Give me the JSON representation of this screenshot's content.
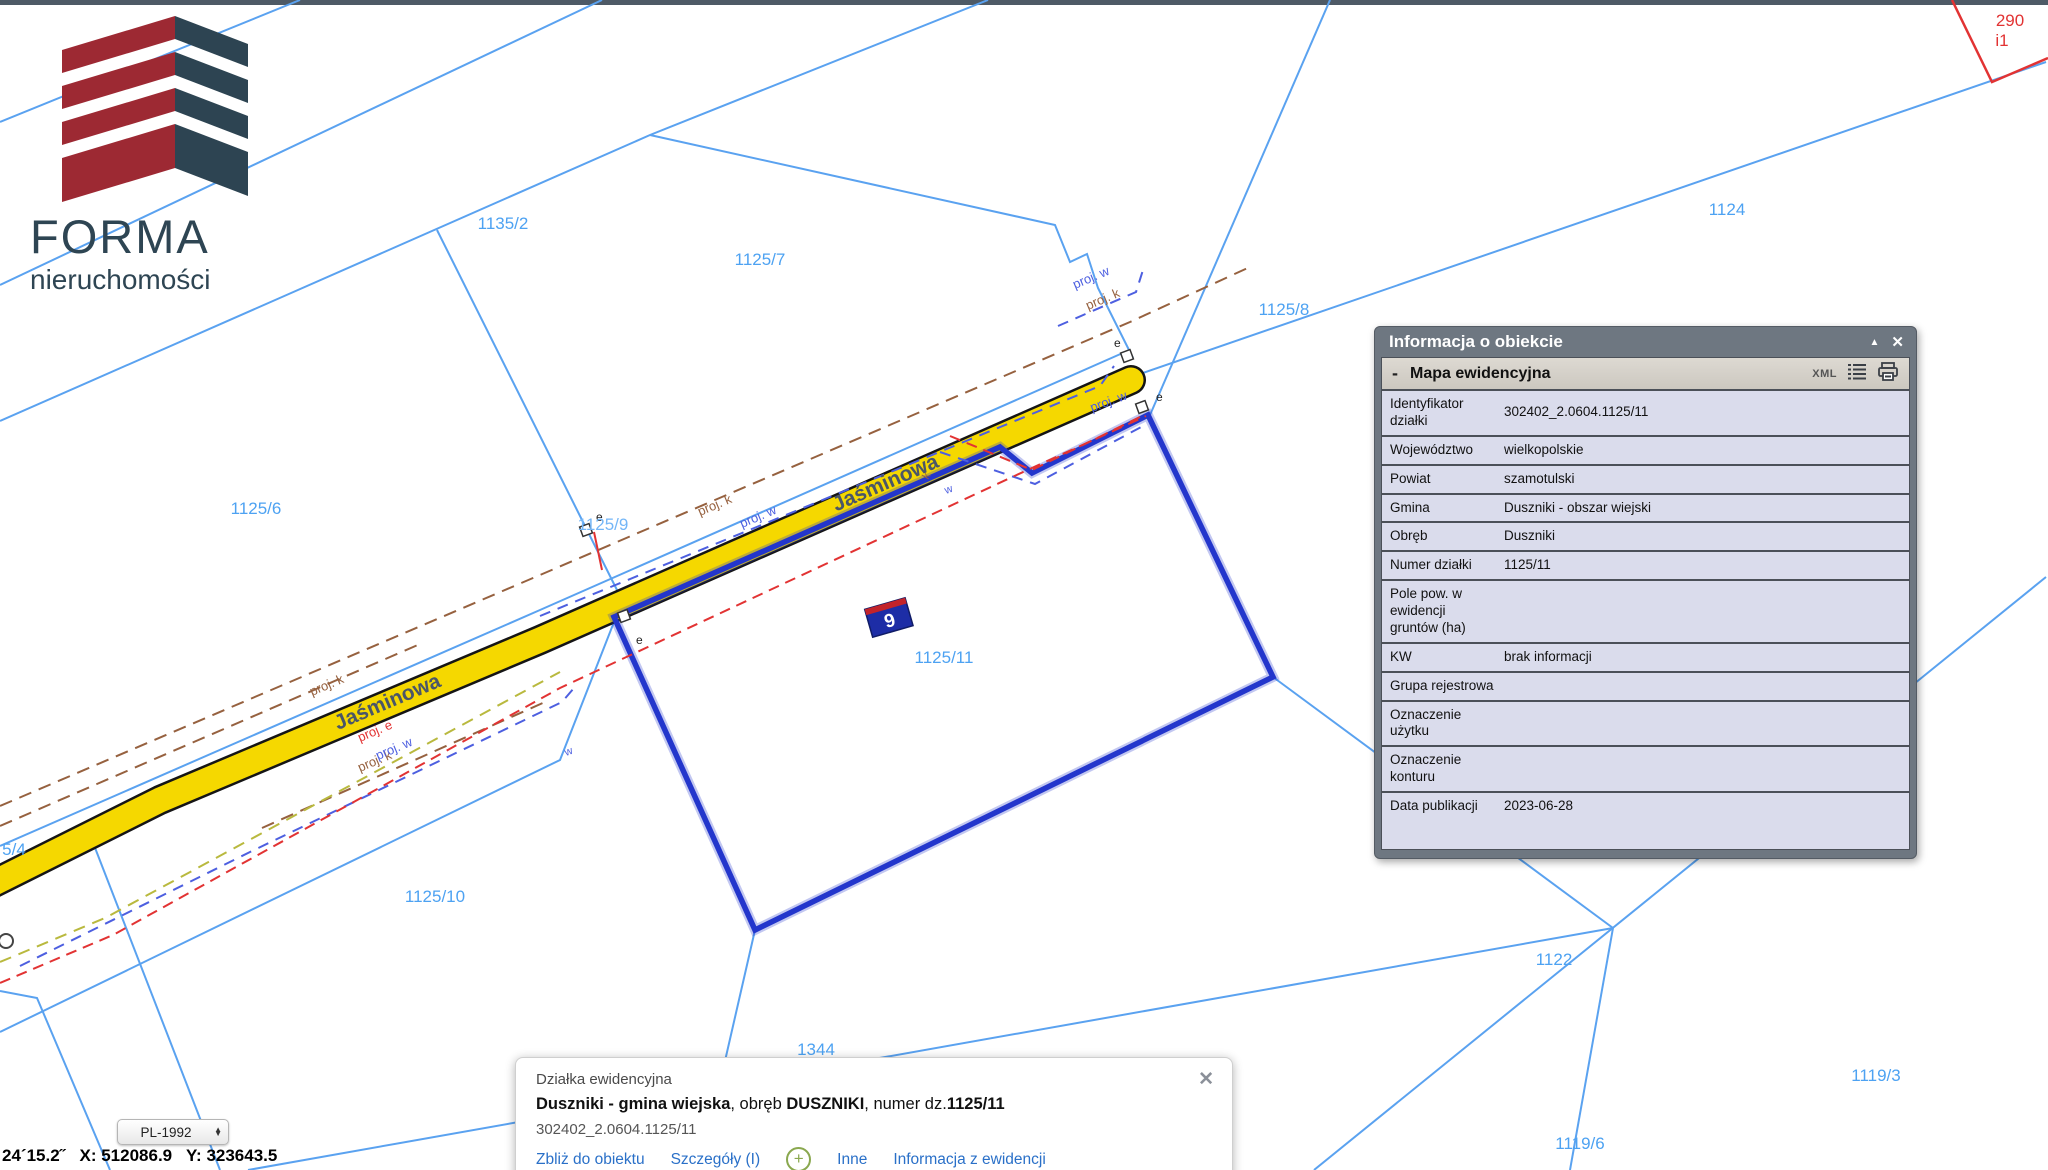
{
  "logo": {
    "name": "FORMA",
    "subtitle": "nieruchomości"
  },
  "map": {
    "street": "Jaśminowa",
    "parcels": [
      "1135",
      "1135/2",
      "1125/7",
      "1125/8",
      "1124",
      "1125/6",
      "1125/9",
      "1125/11",
      "1125/10",
      "1122",
      "1119/3",
      "1119/6",
      "1344",
      "5/4",
      "290",
      "i1"
    ],
    "proj": {
      "k": "proj. k",
      "w": "proj. w",
      "e": "proj. e"
    },
    "tiny": {
      "k": "k",
      "w": "w"
    },
    "house_number": "9",
    "e_symbol": "e",
    "colors": {
      "boundary": "#5aa2f0",
      "selection": "#2336cc",
      "road_fill": "#f5d800",
      "road_casing": "#151515",
      "parcel_label": "#4da2f2",
      "red": "#e23333",
      "brown": "#96613f",
      "proj_blue": "#4d5fe0",
      "olive": "#b9b93e"
    }
  },
  "info_panel": {
    "title": "Informacja o obiekcie",
    "collapse_icon": "▲",
    "close_icon": "✕",
    "section": {
      "minus": "-",
      "title": "Mapa ewidencyjna",
      "xml": "XML"
    },
    "rows": [
      {
        "label": "Identyfikator działki",
        "value": "302402_2.0604.1125/11"
      },
      {
        "label": "Województwo",
        "value": "wielkopolskie"
      },
      {
        "label": "Powiat",
        "value": "szamotulski"
      },
      {
        "label": "Gmina",
        "value": "Duszniki - obszar wiejski"
      },
      {
        "label": "Obręb",
        "value": "Duszniki"
      },
      {
        "label": "Numer działki",
        "value": "1125/11"
      },
      {
        "label": "Pole pow. w ewidencji gruntów (ha)",
        "value": ""
      },
      {
        "label": "KW",
        "value": "brak informacji"
      },
      {
        "label": "Grupa rejestrowa",
        "value": ""
      },
      {
        "label": "Oznaczenie użytku",
        "value": ""
      },
      {
        "label": "Oznaczenie konturu",
        "value": ""
      },
      {
        "label": "Data publikacji",
        "value": "2023-06-28"
      }
    ]
  },
  "popup": {
    "title": "Działka ewidencyjna",
    "bold1": "Duszniki - gmina wiejska",
    "mid1": ", obręb ",
    "bold2": "DUSZNIKI",
    "mid2": ", numer dz.",
    "bold3": "1125/11",
    "id": "302402_2.0604.1125/11",
    "links": [
      "Zbliż do obiektu",
      "Szczegóły (I)",
      "Inne",
      "Informacja z ewidencji"
    ],
    "plus_icon": "+",
    "close_icon": "✕"
  },
  "status_bar": {
    "crs": "PL-1992",
    "coordinates": "24´15.2˝   X: 512086.9   Y: 323643.5"
  }
}
